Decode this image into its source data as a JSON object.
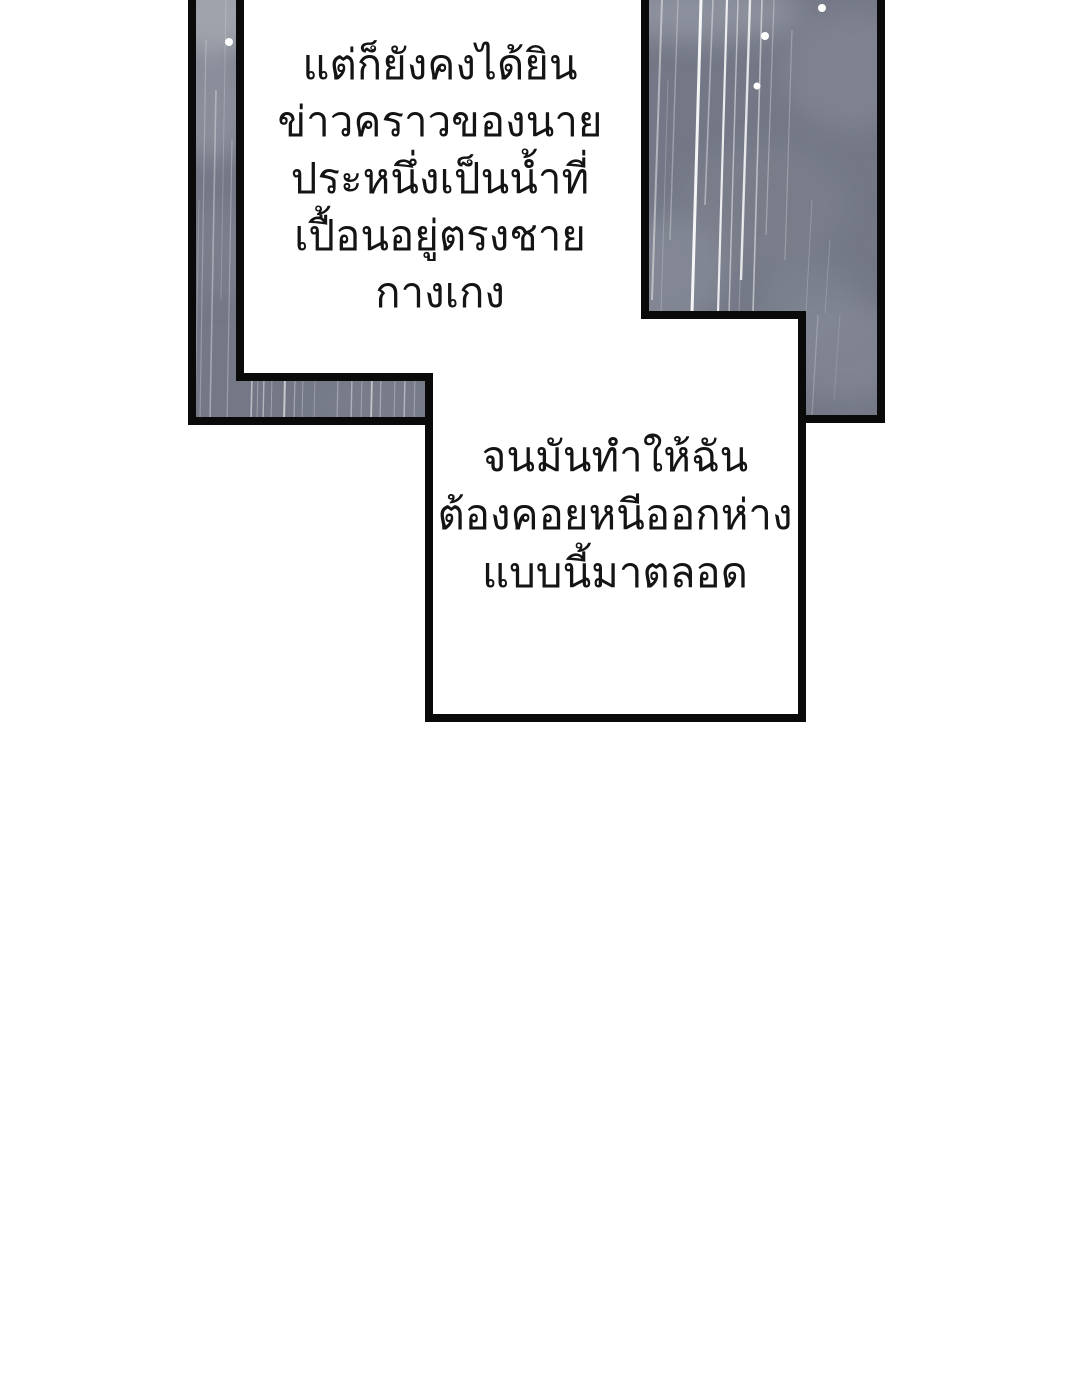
{
  "page": {
    "kind": "webtoon-comic-page",
    "background": "#ffffff",
    "width": 1080,
    "height": 1395
  },
  "colors": {
    "panel_base": "#747886",
    "panel_cloud_light": "#9da0ab",
    "panel_cloud_mid": "#878b97",
    "border": "#0a0a0a",
    "rain": "#ffffff",
    "text": "#141414"
  },
  "narration_top": {
    "lines": [
      "แต่ก็ยังคงได้ยิน",
      "ข่าวคราวของนาย",
      "ประหนึ่งเป็นน้ำที่",
      "เปื้อนอยู่ตรงชายกางเกง"
    ]
  },
  "narration_box": {
    "lines": [
      "จนมันทำให้ฉัน",
      "ต้องคอยหนีออกห่าง",
      "แบบนี้มาตลอด"
    ]
  }
}
